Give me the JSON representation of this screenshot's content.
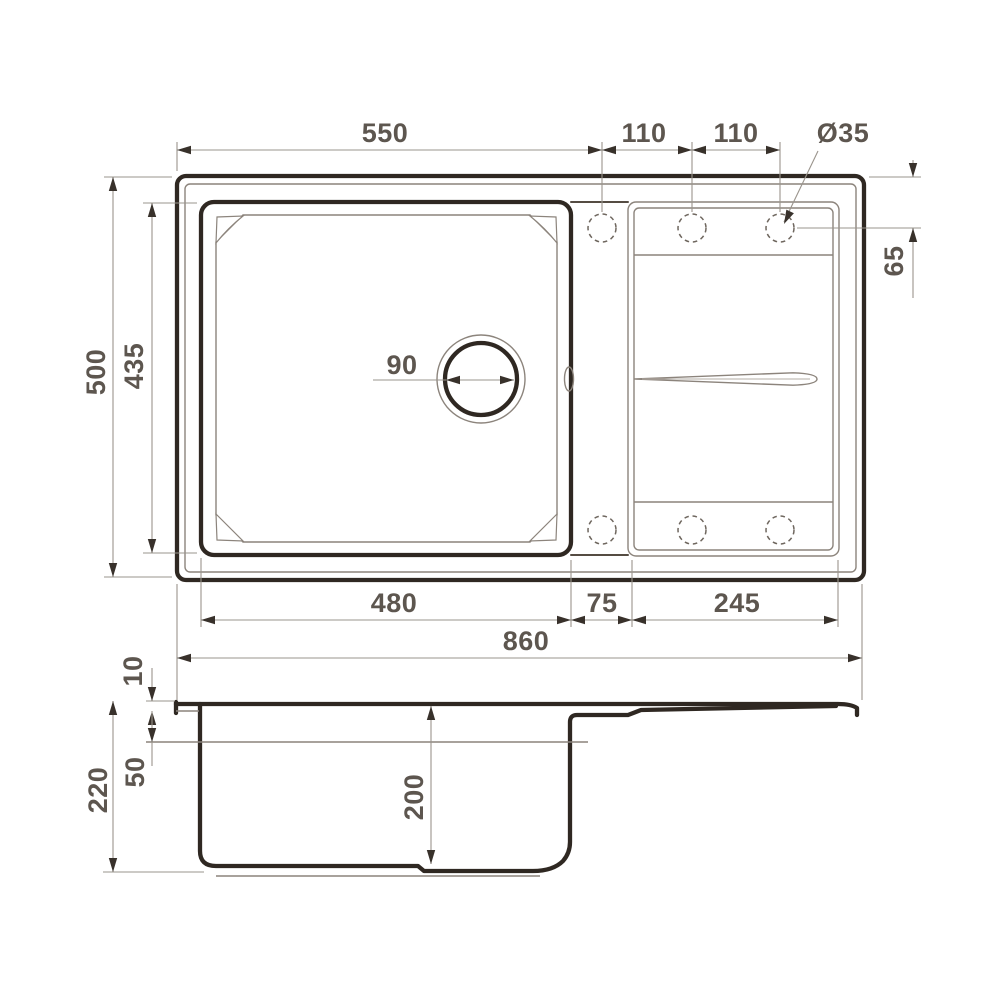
{
  "drawing_type": "sink-dimension-drawing",
  "colors": {
    "background": "#ffffff",
    "outline_dark": "#2f2822",
    "outline_thin": "#8c847c",
    "dimension_line": "#9a948c",
    "dimension_text": "#5d564f"
  },
  "top_view": {
    "dim_550": "550",
    "dim_110_left": "110",
    "dim_110_right": "110",
    "dim_hole_diameter": "Ø35",
    "dim_65": "65",
    "dim_500": "500",
    "dim_435": "435",
    "dim_90": "90",
    "dim_480": "480",
    "dim_75": "75",
    "dim_245": "245"
  },
  "between_views": {
    "dim_860": "860"
  },
  "side_view": {
    "dim_10": "10",
    "dim_50": "50",
    "dim_220": "220",
    "dim_200": "200"
  }
}
